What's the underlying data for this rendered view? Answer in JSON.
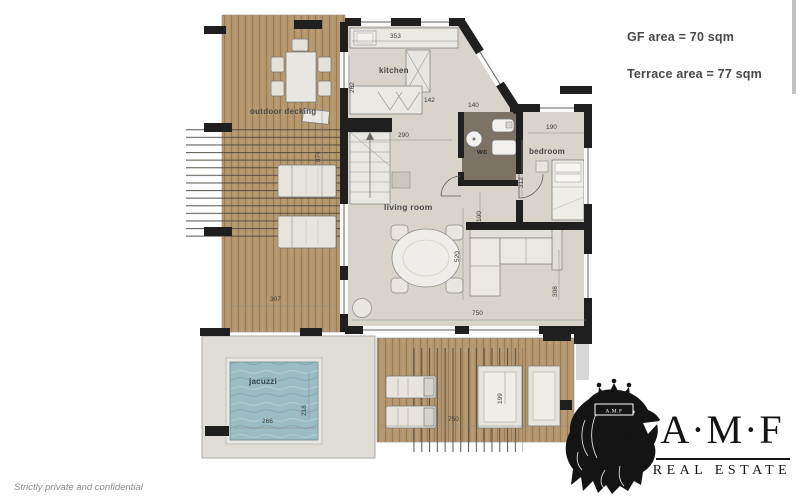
{
  "stats": {
    "gf_area": "GF area = 70 sqm",
    "terrace_area": "Terrace area = 77 sqm"
  },
  "floorplan": {
    "rooms": {
      "outdoor_decking": "outdoor decking",
      "kitchen": "kitchen",
      "living_room": "living room",
      "wc": "wc",
      "bedroom": "bedroom",
      "jacuzzi": "jacuzzi"
    },
    "dimensions": {
      "kitchen_width": "353",
      "kitchen_depth": "262",
      "kitchen_inner": "142",
      "living_top": "290",
      "living_height": "520",
      "living_width": "750",
      "hall": "100",
      "wc_width": "140",
      "bedroom_width": "190",
      "bedroom_depth": "312",
      "sofa_wall": "308",
      "decking_width": "307",
      "decking_height": "874",
      "jacuzzi_width": "266",
      "jacuzzi_depth": "218",
      "terrace_width": "750",
      "terrace_depth": "199"
    }
  },
  "logo": {
    "wordmark": "A·M·F",
    "subtitle": "REAL ESTATE",
    "crown_text": "A.M.F"
  },
  "footer": {
    "note": "Strictly private and confidential"
  }
}
